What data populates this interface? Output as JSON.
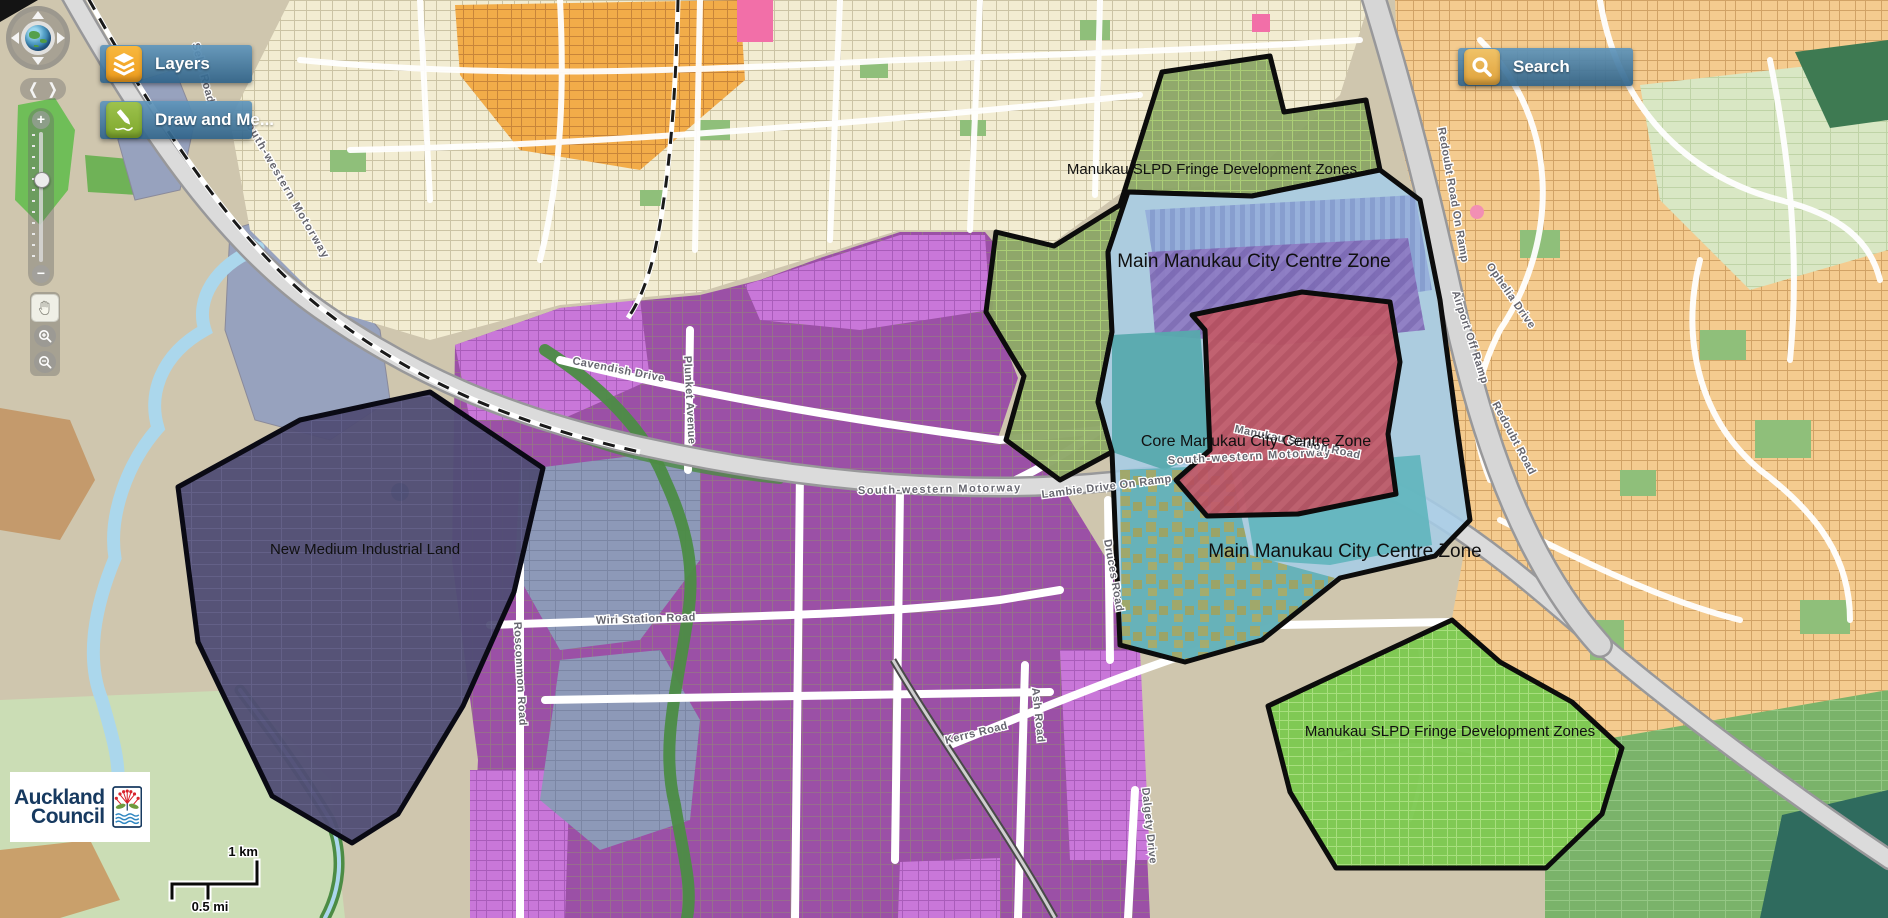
{
  "map_viewer": {
    "toolbar": {
      "layers_label": "Layers",
      "draw_label": "Draw and Me..."
    },
    "search": {
      "label": "Search"
    },
    "logo": {
      "line1": "Auckland",
      "line2": "Council"
    },
    "scale_bar": {
      "km": "1 km",
      "mi": "0.5 mi"
    },
    "zones": [
      {
        "id": "slpd-fringe-north",
        "label": "Manukau SLPD Fringe Development Zones",
        "color": "#8CA566"
      },
      {
        "id": "main-city-centre-north",
        "label": "Main Manukau City Centre Zone",
        "color": "#A6CCE7"
      },
      {
        "id": "core-city-centre",
        "label": "Core Manukau City Centre Zone",
        "color": "#B5505F"
      },
      {
        "id": "main-city-centre-south",
        "label": "Main Manukau City Centre Zone",
        "color": "#5FAFB5"
      },
      {
        "id": "new-medium-industrial-land",
        "label": "New Medium Industrial Land",
        "color": "#504D74"
      },
      {
        "id": "slpd-fringe-south",
        "label": "Manukau SLPD Fringe Development Zones",
        "color": "#7CC94F"
      }
    ],
    "road_labels": {
      "motorway_west": "South-western Motorway",
      "motorway_mid": "South-western Motorway",
      "motorway_east": "South-western Motorway",
      "lambie_on_ramp": "Lambie Drive On Ramp",
      "airport_off_ramp": "Airport Off Ramp",
      "redoubt_on_ramp": "Redoubt Road On Ramp",
      "redoubt_road": "Redoubt Road",
      "ophelia_drive": "Ophelia Drive",
      "kerrs_road": "Kerrs Road",
      "ash_road": "Ash Road",
      "dalgety_drive": "Dalgety Drive",
      "cavendish_drive": "Cavendish Drive",
      "wiri_station_road": "Wiri Station Road",
      "roscommon_road": "Roscommon Road",
      "plunket_avenue": "Plunket Avenue",
      "druces_road": "Druces Road",
      "manukau_station_road": "Manukau Station Road",
      "selfs_road": "Selfs Road"
    },
    "colors": {
      "panel_blue": "#3E7CA6",
      "layers_icon": "#F2A732",
      "draw_icon": "#8DB63F",
      "search_icon": "#E9B44C",
      "water": "#ABD7EC",
      "industrial_purple": "#9B50A6"
    }
  }
}
